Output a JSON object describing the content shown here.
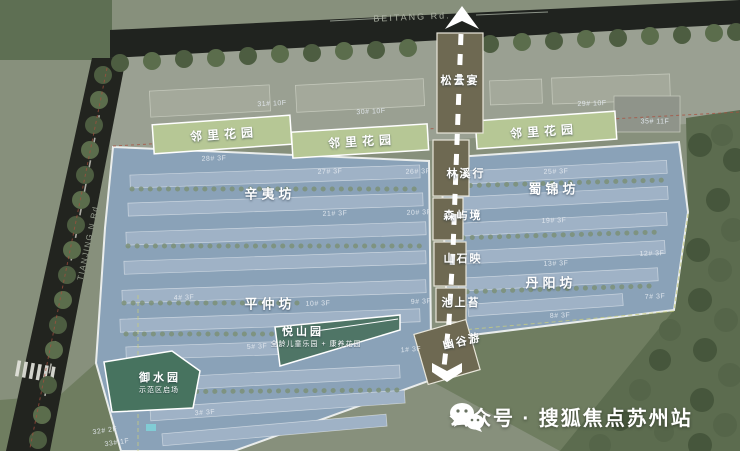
{
  "map": {
    "roads": {
      "top": "BEITANG Rd.",
      "left": "TIANJING N Rd"
    },
    "axis": {
      "nodes": [
        "松云宴",
        "林溪行",
        "森屿境",
        "山石映",
        "池上苔",
        "幽谷游"
      ]
    },
    "gardens": {
      "neighborhood_garden": "邻里花园"
    },
    "zones": [
      "辛夷坊",
      "蜀锦坊",
      "平仲坊",
      "丹阳坊"
    ],
    "parks": [
      {
        "name": "悦山园",
        "subtitle": "全龄儿童乐园 + 康养花园"
      },
      {
        "name": "御水园",
        "subtitle": "示范区启场"
      }
    ],
    "buildings": [
      "31# 10F",
      "30# 10F",
      "29# 10F",
      "35# 11F",
      "28# 3F",
      "27# 3F",
      "26# 3F",
      "25# 3F",
      "21# 3F",
      "20# 3F",
      "19# 3F",
      "13# 3F",
      "12# 3F",
      "10# 3F",
      "9# 3F",
      "7# 3F",
      "8# 3F",
      "5# 3F",
      "4# 3F",
      "1# 3F",
      "3# 3F",
      "32# 2F",
      "33# 1F"
    ]
  },
  "watermark": {
    "icon": "wechat-icon",
    "label": "公众号 · 搜狐焦点苏州站"
  },
  "colors": {
    "parcel_blue": "#8ba4bd",
    "building_row": "#9fb2c6",
    "garden_band": "#b6c795",
    "axis_olive": "#6e6952",
    "park_teal": "#4f7566",
    "park_deep_teal": "#47735f",
    "road_dark": "#20231f",
    "forest": "#5c6c4f"
  }
}
